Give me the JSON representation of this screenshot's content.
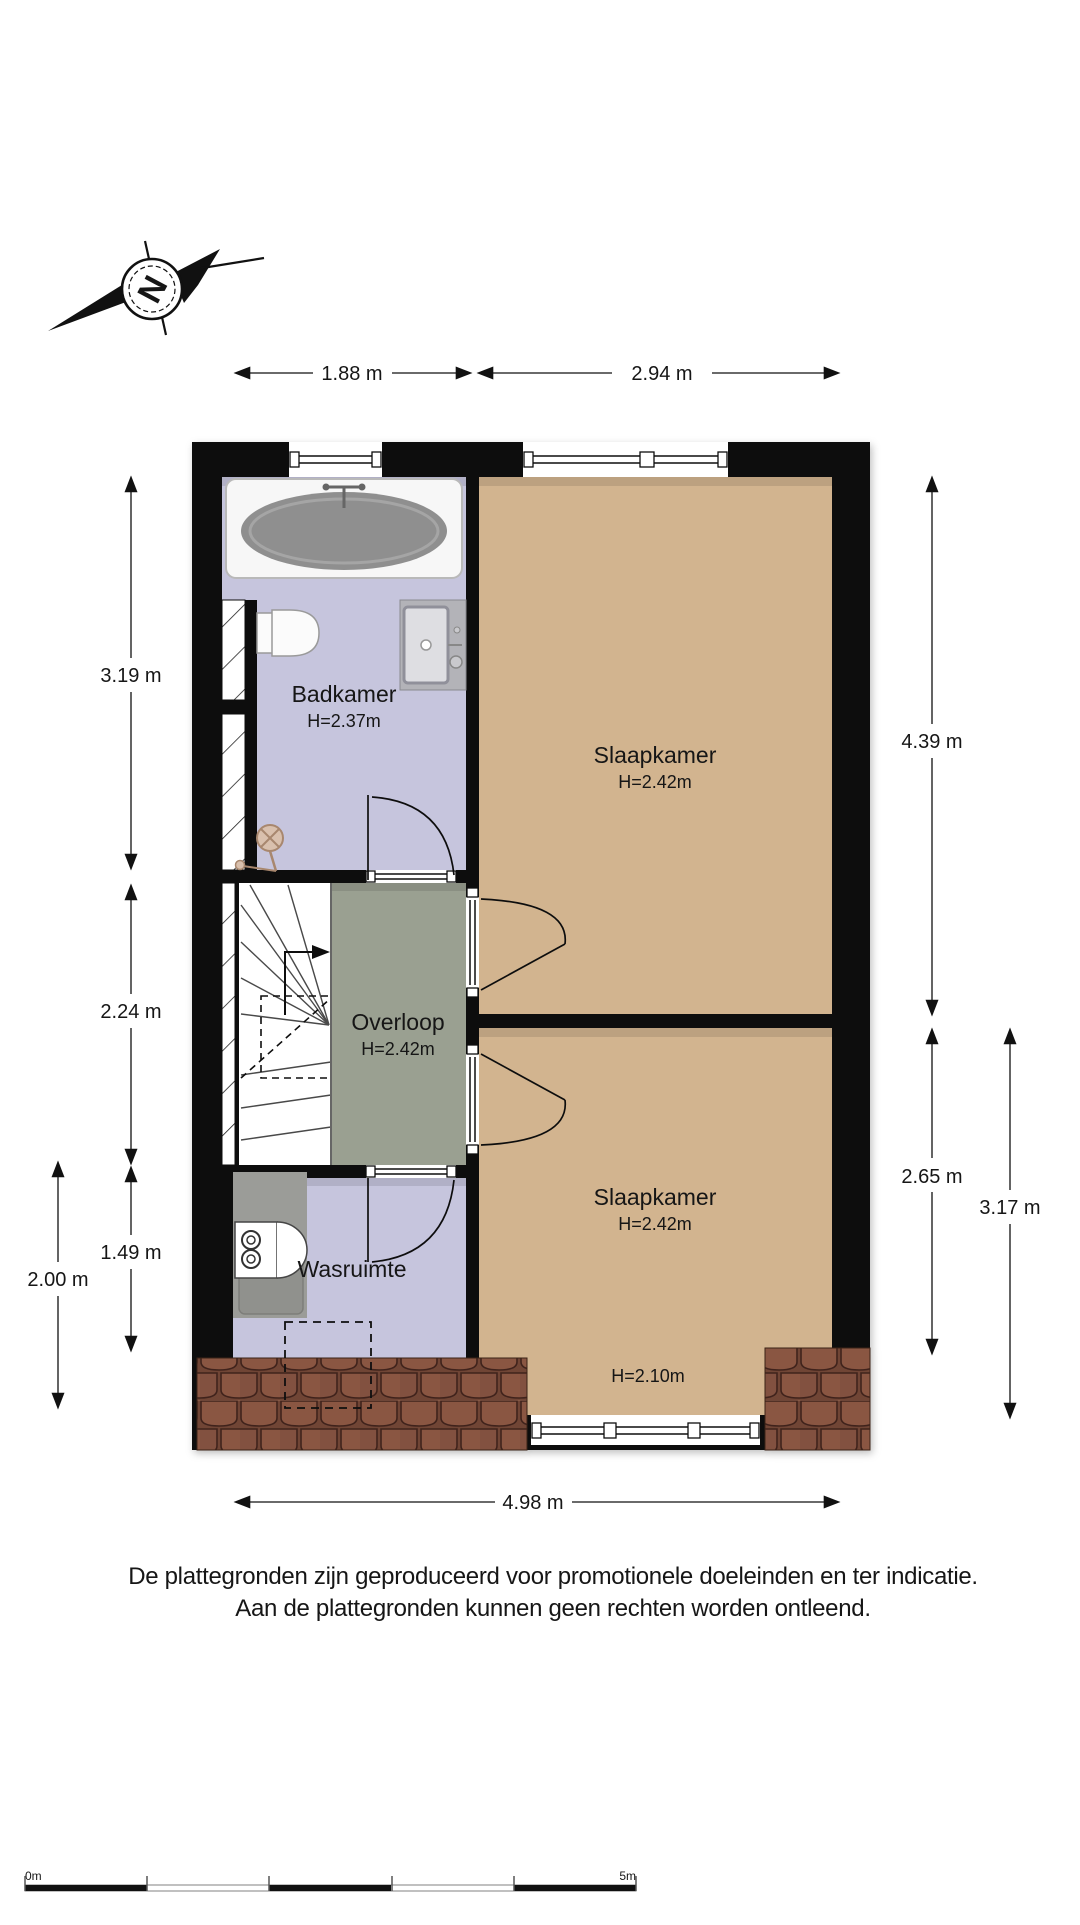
{
  "page": {
    "background": "#ffffff"
  },
  "compass": {
    "letter": "N"
  },
  "plan": {
    "wall_color": "#0d0d0d",
    "roof_color": "#7d4f3c",
    "rooms": {
      "badkamer": {
        "name": "Badkamer",
        "ceiling": "H=2.37m",
        "floor_color": "#c6c5dd"
      },
      "slaapkamer_boven": {
        "name": "Slaapkamer",
        "ceiling": "H=2.42m",
        "floor_color": "#d2b48f"
      },
      "overloop": {
        "name": "Overloop",
        "ceiling": "H=2.42m",
        "floor_color": "#9aa091"
      },
      "wasruimte": {
        "name": "Wasruimte",
        "floor_color": "#c6c5dd"
      },
      "slaapkamer_onder": {
        "name": "Slaapkamer",
        "ceiling": "H=2.42m",
        "ceiling_low": "H=2.10m",
        "floor_color": "#d2b48f"
      }
    }
  },
  "dimensions": {
    "top_left": "1.88 m",
    "top_right": "2.94 m",
    "left_badkamer": "3.19 m",
    "left_overloop": "2.24 m",
    "left_wasruimte": "1.49 m",
    "left_outer": "2.00 m",
    "right_slaapkamer_boven": "4.39 m",
    "right_slaapkamer_onder": "2.65 m",
    "right_outer": "3.17 m",
    "bottom": "4.98 m"
  },
  "scale_bar": {
    "start_label": "0m",
    "end_label": "5m"
  },
  "disclaimer": {
    "line1": "De plattegronden zijn geproduceerd voor promotionele doeleinden en ter indicatie.",
    "line2": "Aan de plattegronden kunnen geen rechten worden ontleend."
  }
}
